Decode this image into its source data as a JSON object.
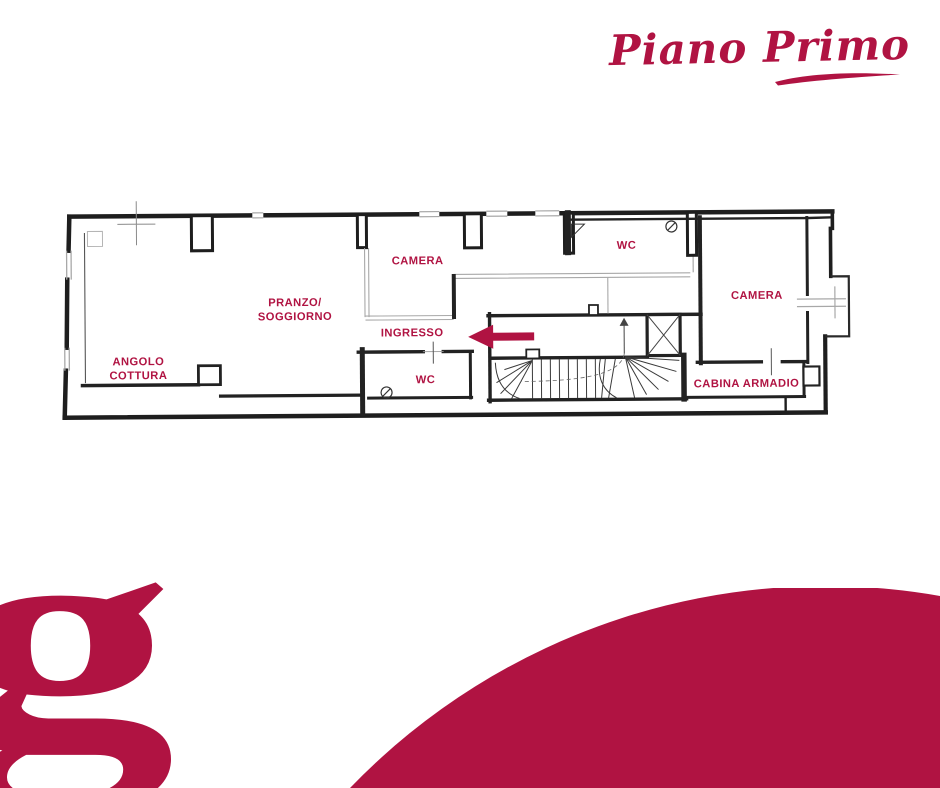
{
  "header": {
    "title": "Piano Primo"
  },
  "plan": {
    "rooms": [
      {
        "name": "angolo-cottura",
        "lines": [
          "ANGOLO",
          "COTTURA"
        ]
      },
      {
        "name": "pranzo-soggiorno",
        "lines": [
          "PRANZO/",
          "SOGGIORNO"
        ]
      },
      {
        "name": "camera-1",
        "lines": [
          "CAMERA"
        ]
      },
      {
        "name": "ingresso",
        "lines": [
          "INGRESSO"
        ]
      },
      {
        "name": "wc-1",
        "lines": [
          "WC"
        ]
      },
      {
        "name": "wc-2",
        "lines": [
          "WC"
        ]
      },
      {
        "name": "camera-2",
        "lines": [
          "CAMERA"
        ]
      },
      {
        "name": "cabina-armadio",
        "lines": [
          "CABINA ARMADIO"
        ]
      }
    ],
    "features": [
      "staircase",
      "elevator-shaft",
      "balcony",
      "entrance-arrow"
    ]
  },
  "logo": {
    "letter": "g"
  },
  "colors": {
    "accent": "#B01342",
    "wall": "#1E1E1E",
    "light_wall": "#A8A8A8",
    "background": "#FFFFFF"
  }
}
